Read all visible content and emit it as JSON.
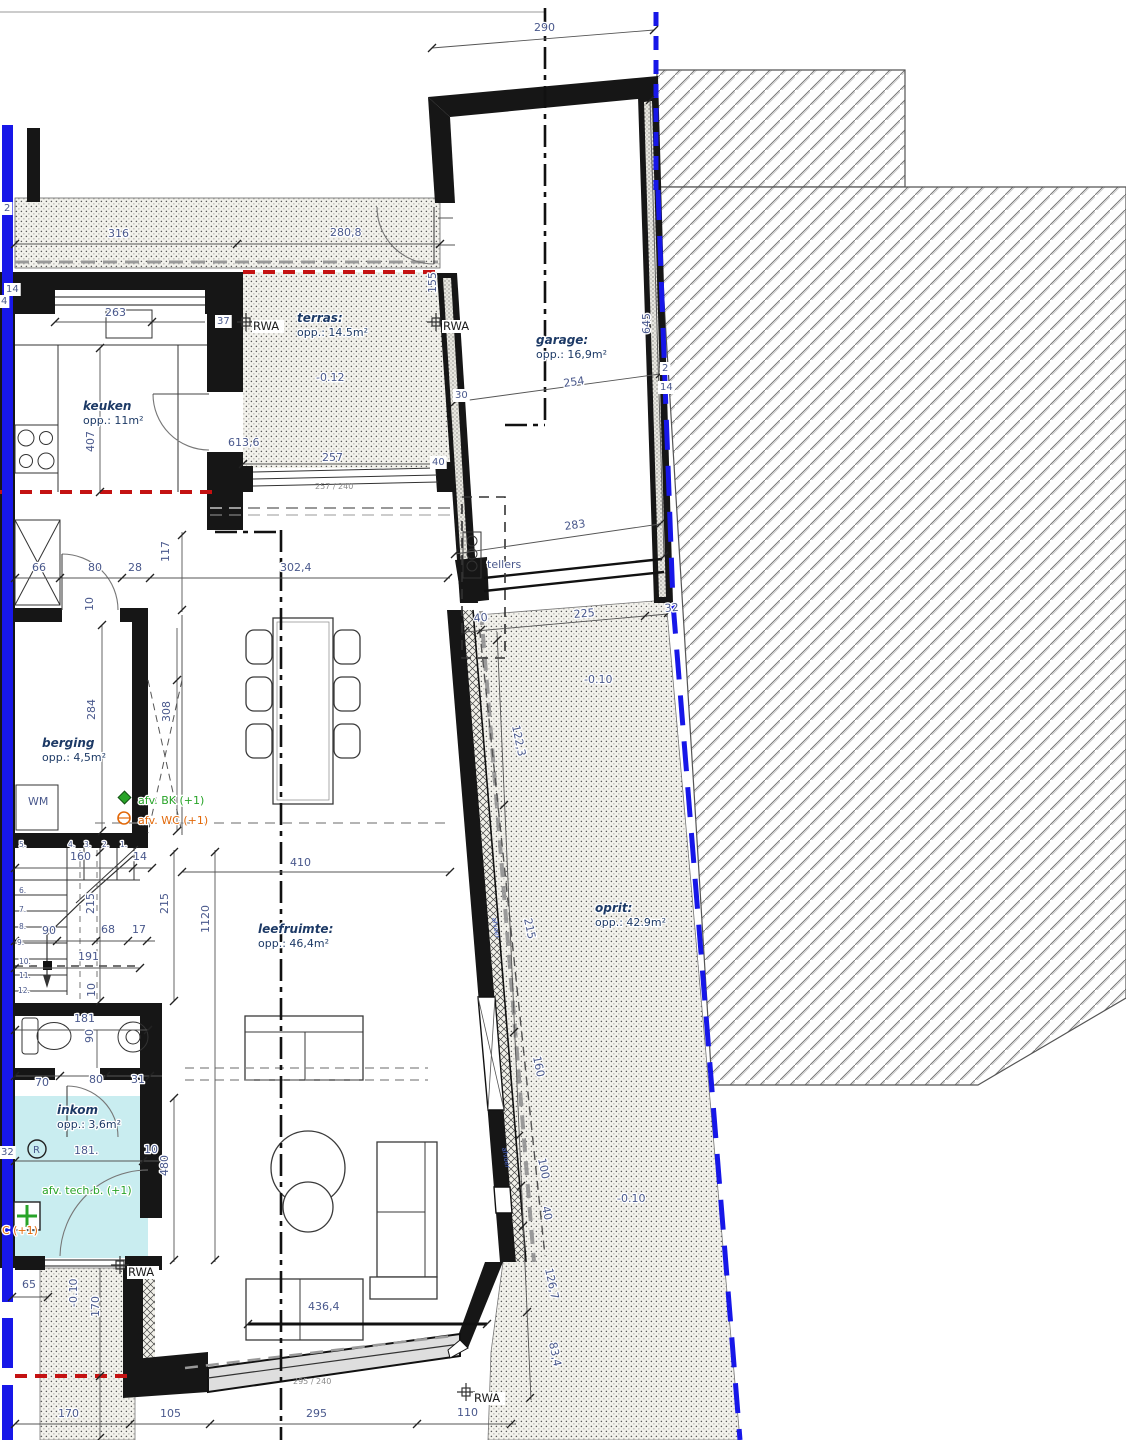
{
  "drawing": {
    "title": "grondplan gelijkvloers",
    "type": "architectural floor plan"
  },
  "colors": {
    "property_line_blue": "#1717e8",
    "red_dashed_line": "#c41212",
    "dimension_text": "#49588c",
    "room_label": "#1d3a66",
    "green_annotation": "#28a428",
    "orange_annotation": "#e2690a",
    "inkom_floor_cyan": "#c9edf0"
  },
  "rooms": [
    {
      "id": "terras",
      "label": "terras:",
      "area": "opp.: 14.5m²",
      "level": "-0.12"
    },
    {
      "id": "garage",
      "label": "garage:",
      "area": "opp.: 16,9m²"
    },
    {
      "id": "keuken",
      "label": "keuken",
      "area": "opp.: 11m²"
    },
    {
      "id": "berging",
      "label": "berging",
      "area": "opp.: 4,5m²"
    },
    {
      "id": "leefruimte",
      "label": "leefruimte:",
      "area": "opp.: 46,4m²"
    },
    {
      "id": "inkom",
      "label": "inkom",
      "area": "opp.: 3,6m²"
    },
    {
      "id": "oprit",
      "label": "oprit:",
      "area": "opp.: 42.9m²",
      "level": "-0.10"
    }
  ],
  "rwa": {
    "label": "RWA"
  },
  "appliances": {
    "wm": "WM",
    "tellers": "tellers"
  },
  "annotations": {
    "green1": "afv. BK (+1)",
    "orange1": "afv. WC (+1)",
    "green2": "afv. tech.b. (+1)",
    "orange2": "C (+1)",
    "r_symbol": "R",
    "drain1": "afvoer",
    "drain2": "afvoer"
  },
  "window_specs": {
    "terras_door": "257 / 240",
    "living_window": "295 / 240"
  },
  "dims": [
    {
      "t": "290",
      "x": 534,
      "y": 31
    },
    {
      "t": "316",
      "x": 108,
      "y": 237
    },
    {
      "t": "280,8",
      "x": 330,
      "y": 236
    },
    {
      "t": "263",
      "x": 105,
      "y": 316
    },
    {
      "t": "-0.12",
      "x": 316,
      "y": 381
    },
    {
      "t": "407",
      "x": 94,
      "y": 452,
      "r": -90
    },
    {
      "t": "613,6",
      "x": 228,
      "y": 446
    },
    {
      "t": "257",
      "x": 322,
      "y": 461
    },
    {
      "t": "155",
      "x": 436,
      "y": 293,
      "r": -90
    },
    {
      "t": "645",
      "x": 650,
      "y": 334,
      "r": -90
    },
    {
      "t": "254",
      "x": 564,
      "y": 387,
      "r": -8
    },
    {
      "t": "283",
      "x": 565,
      "y": 530,
      "r": -8
    },
    {
      "t": "40",
      "x": 474,
      "y": 622,
      "r": -5
    },
    {
      "t": "225",
      "x": 574,
      "y": 618,
      "r": -5
    },
    {
      "t": "32",
      "x": 665,
      "y": 612,
      "r": -5
    },
    {
      "t": "-0.10",
      "x": 584,
      "y": 683
    },
    {
      "t": "122,3",
      "x": 512,
      "y": 726,
      "r": 78
    },
    {
      "t": "215",
      "x": 524,
      "y": 919,
      "r": 78
    },
    {
      "t": "160",
      "x": 533,
      "y": 1057,
      "r": 78
    },
    {
      "t": "100",
      "x": 538,
      "y": 1159,
      "r": 78
    },
    {
      "t": "40",
      "x": 542,
      "y": 1207,
      "r": 78
    },
    {
      "t": "126,7",
      "x": 545,
      "y": 1269,
      "r": 78
    },
    {
      "t": "83,4",
      "x": 549,
      "y": 1343,
      "r": 78
    },
    {
      "t": "-0.10",
      "x": 617,
      "y": 1202
    },
    {
      "t": "66",
      "x": 32,
      "y": 571
    },
    {
      "t": "80",
      "x": 88,
      "y": 571
    },
    {
      "t": "28",
      "x": 128,
      "y": 571
    },
    {
      "t": "117",
      "x": 169,
      "y": 562,
      "r": -90
    },
    {
      "t": "302,4",
      "x": 280,
      "y": 571
    },
    {
      "t": "10",
      "x": 93,
      "y": 611,
      "r": -90,
      "s": 9
    },
    {
      "t": "284",
      "x": 95,
      "y": 720,
      "r": -90
    },
    {
      "t": "308",
      "x": 170,
      "y": 722,
      "r": -90
    },
    {
      "t": "410",
      "x": 290,
      "y": 866
    },
    {
      "t": "160",
      "x": 70,
      "y": 860
    },
    {
      "t": "14",
      "x": 133,
      "y": 860
    },
    {
      "t": "215",
      "x": 94,
      "y": 914,
      "r": -90
    },
    {
      "t": "215",
      "x": 168,
      "y": 914,
      "r": -90
    },
    {
      "t": "1120",
      "x": 209,
      "y": 933,
      "r": -90
    },
    {
      "t": "90",
      "x": 42,
      "y": 934
    },
    {
      "t": "68",
      "x": 101,
      "y": 933
    },
    {
      "t": "17",
      "x": 132,
      "y": 933
    },
    {
      "t": "191",
      "x": 78,
      "y": 960
    },
    {
      "t": "10",
      "x": 95,
      "y": 997,
      "r": -90,
      "s": 9
    },
    {
      "t": "181",
      "x": 74,
      "y": 1022
    },
    {
      "t": "90",
      "x": 93,
      "y": 1043,
      "r": -90
    },
    {
      "t": "70",
      "x": 35,
      "y": 1086
    },
    {
      "t": "80",
      "x": 89,
      "y": 1083
    },
    {
      "t": "31",
      "x": 131,
      "y": 1083
    },
    {
      "t": "181.",
      "x": 74,
      "y": 1154
    },
    {
      "t": "10",
      "x": 144,
      "y": 1153
    },
    {
      "t": "480",
      "x": 168,
      "y": 1176,
      "r": -90
    },
    {
      "t": "65",
      "x": 22,
      "y": 1288
    },
    {
      "t": "-0.10",
      "x": 77,
      "y": 1307,
      "r": -90
    },
    {
      "t": "170",
      "x": 99,
      "y": 1317,
      "r": -90
    },
    {
      "t": "170",
      "x": 58,
      "y": 1417
    },
    {
      "t": "105",
      "x": 160,
      "y": 1417
    },
    {
      "t": "295",
      "x": 306,
      "y": 1417
    },
    {
      "t": "110",
      "x": 457,
      "y": 1416
    },
    {
      "t": "436,4",
      "x": 308,
      "y": 1310
    }
  ],
  "wall_tags": [
    {
      "t": "2",
      "x": 4,
      "y": 211
    },
    {
      "t": "14",
      "x": 6,
      "y": 292
    },
    {
      "t": "4",
      "x": 1,
      "y": 304
    },
    {
      "t": "37",
      "x": 217,
      "y": 324
    },
    {
      "t": "40",
      "x": 432,
      "y": 465
    },
    {
      "t": "30",
      "x": 455,
      "y": 398
    },
    {
      "t": "2",
      "x": 662,
      "y": 371
    },
    {
      "t": "14",
      "x": 660,
      "y": 390
    },
    {
      "t": "32",
      "x": 1,
      "y": 1155
    }
  ],
  "stair_steps": [
    {
      "t": "5.",
      "x": 19,
      "y": 847
    },
    {
      "t": "4.",
      "x": 68,
      "y": 847
    },
    {
      "t": "3.",
      "x": 84,
      "y": 847
    },
    {
      "t": "2.",
      "x": 102,
      "y": 847
    },
    {
      "t": "1.",
      "x": 120,
      "y": 847
    },
    {
      "t": "6.",
      "x": 19,
      "y": 893
    },
    {
      "t": "7.",
      "x": 19,
      "y": 912
    },
    {
      "t": "8.",
      "x": 19,
      "y": 929
    },
    {
      "t": "9.",
      "x": 17,
      "y": 945
    },
    {
      "t": "10.",
      "x": 19,
      "y": 964
    },
    {
      "t": "11.",
      "x": 19,
      "y": 978
    },
    {
      "t": "12.",
      "x": 18,
      "y": 993
    }
  ]
}
